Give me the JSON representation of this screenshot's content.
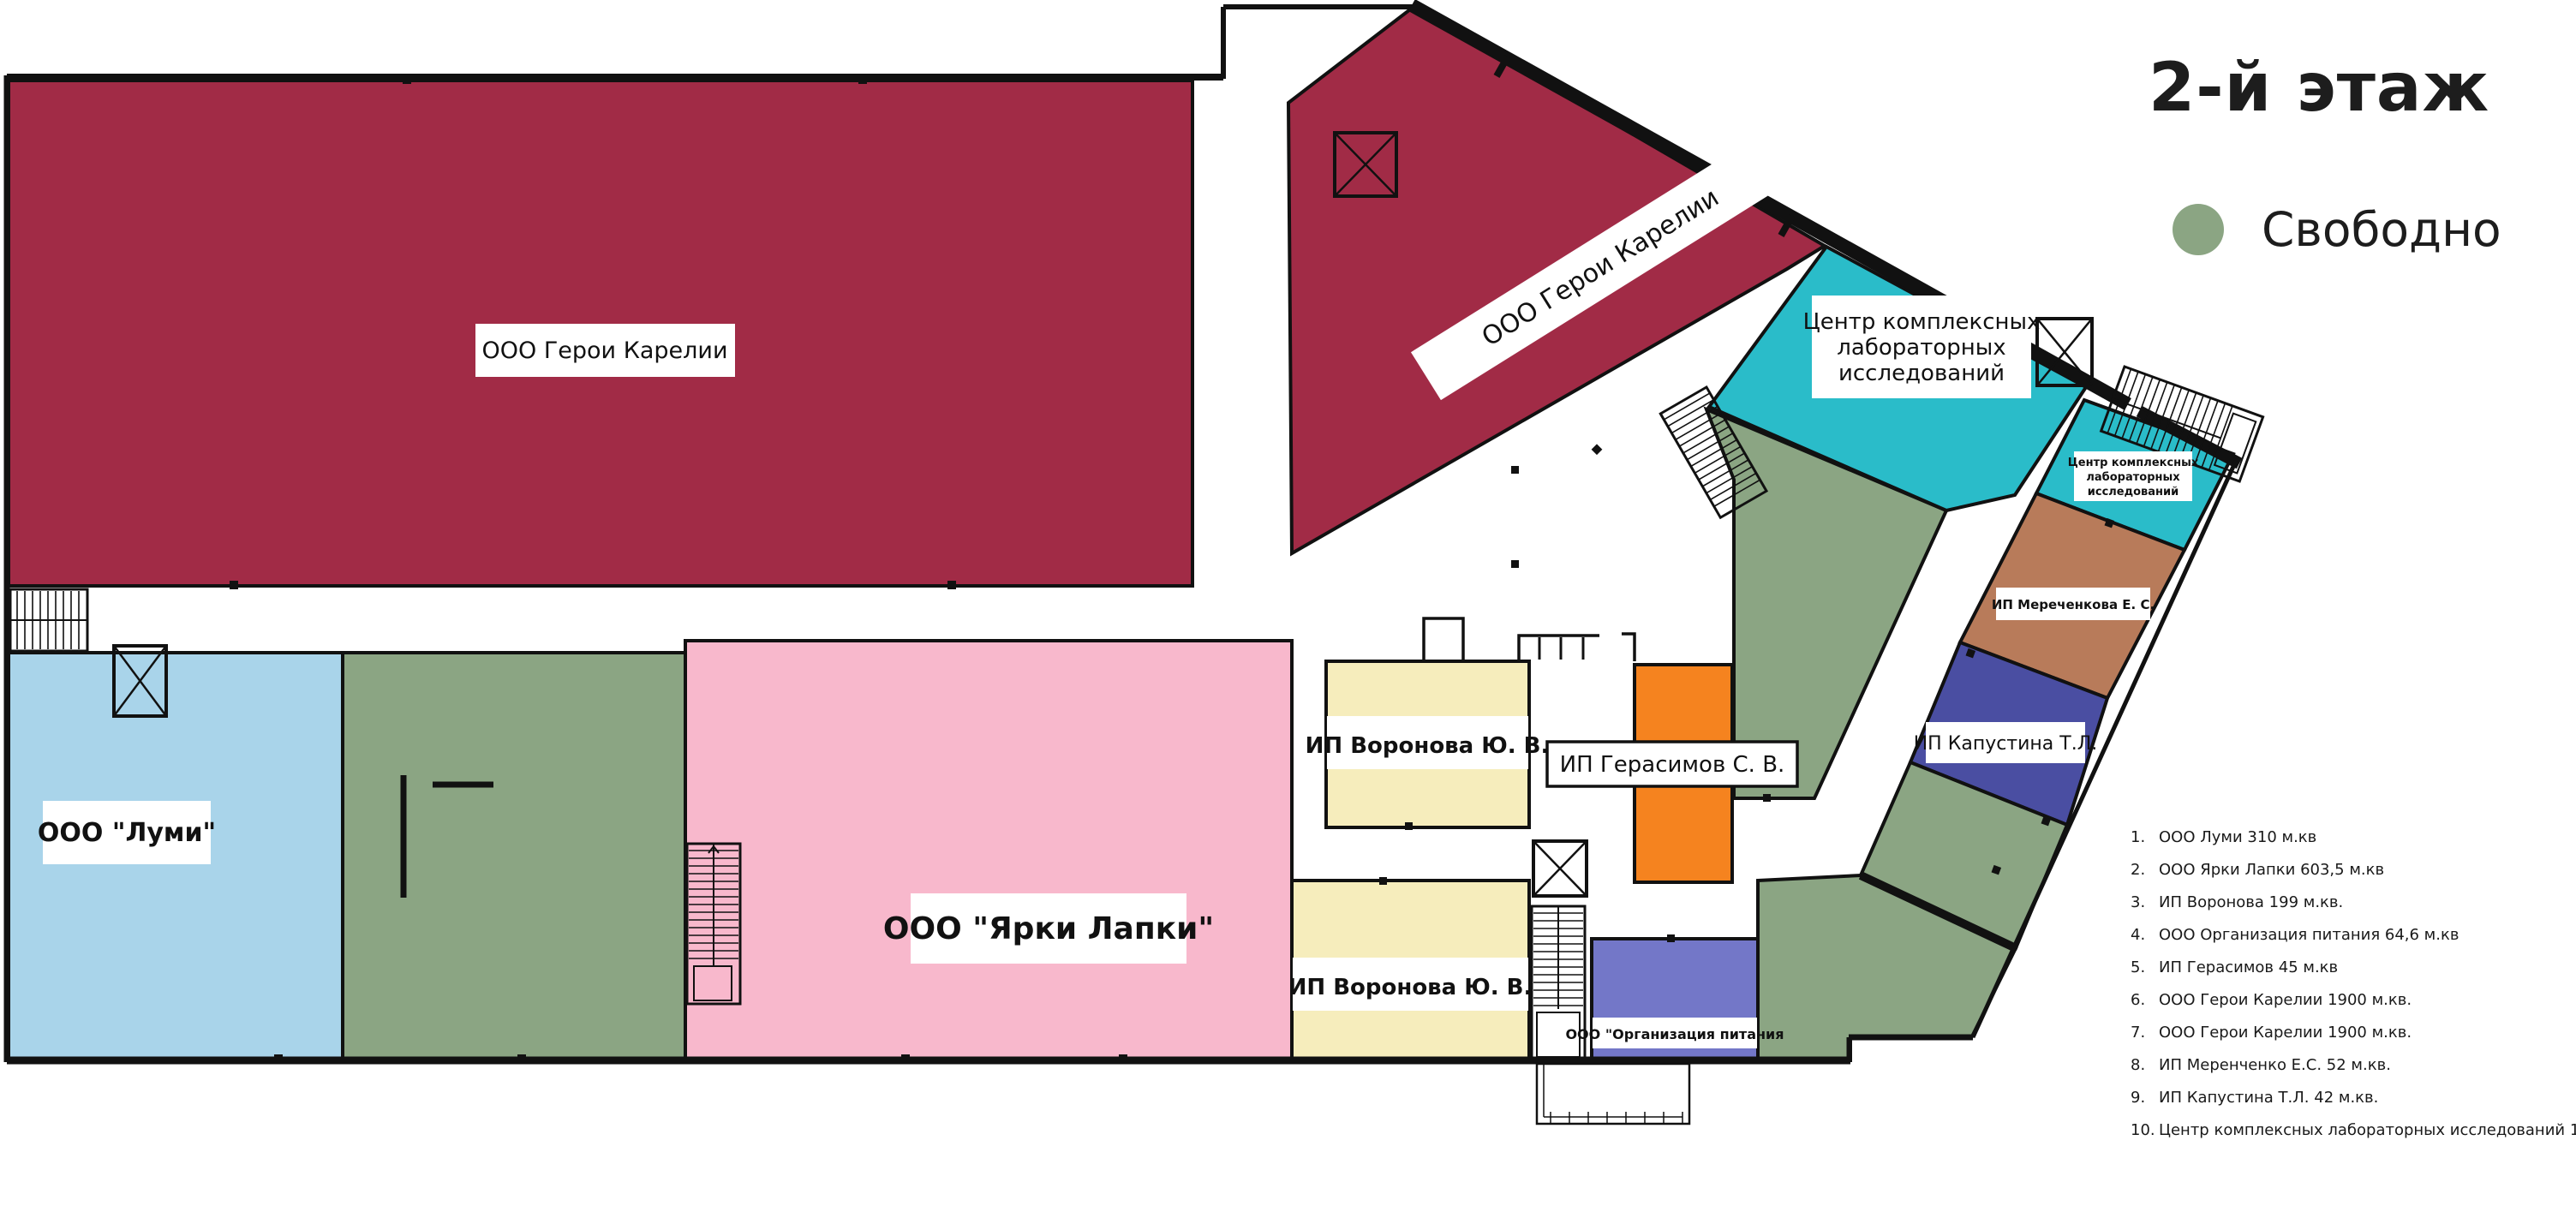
{
  "title": "2-й этаж",
  "legend": {
    "label": "Свободно",
    "color": "#8BA583"
  },
  "plan": {
    "areas": {
      "geroi1": {
        "label": "ООО Герои Карелии",
        "color": "#A12B46"
      },
      "geroi2": {
        "label": "ООО Герои Карелии",
        "color": "#A12B46"
      },
      "lumi": {
        "label": "ООО \"Луми\"",
        "color": "#A9D4EA"
      },
      "free": {
        "color": "#8BA583"
      },
      "yarki": {
        "label": "ООО \"Ярки Лапки\"",
        "color": "#F8B8CC"
      },
      "voronova_top": {
        "label": "ИП Воронова Ю. В.",
        "color": "#F6EDBC"
      },
      "voronova_bottom": {
        "label": "ИП Воронова Ю. В.",
        "color": "#F6EDBC"
      },
      "gerasimov": {
        "label": "ИП Герасимов С. В.",
        "color": "#F5831F"
      },
      "org_pitaniya": {
        "label": "ООО \"Организация питания",
        "color": "#7377C8"
      },
      "clinic_big": {
        "label_lines": [
          "Центр комплексных",
          "лабораторных",
          "исследований"
        ],
        "color": "#2ABCC9"
      },
      "clinic_small": {
        "label_lines": [
          "Центр комплексных",
          "лабораторных",
          "исследований"
        ],
        "color": "#2ABCC9"
      },
      "merechenkova": {
        "label": "ИП Мереченкова  Е. С.",
        "color": "#B87B5A"
      },
      "kapustina": {
        "label": "ИП Капустина Т.Л.",
        "color": "#4A4EA2"
      }
    }
  },
  "list": {
    "items": [
      {
        "num": "1.",
        "label": "ООО Луми 310 м.кв"
      },
      {
        "num": "2.",
        "label": "ООО Ярки Лапки  603,5 м.кв"
      },
      {
        "num": "3.",
        "label": "ИП Воронова 199 м.кв."
      },
      {
        "num": "4.",
        "label": "ООО Организация питания 64,6 м.кв"
      },
      {
        "num": "5.",
        "label": "ИП Герасимов 45 м.кв"
      },
      {
        "num": "6.",
        "label": "ООО  Герои Карелии 1900 м.кв."
      },
      {
        "num": "7.",
        "label": "ООО  Герои Карелии 1900 м.кв."
      },
      {
        "num": "8.",
        "label": "ИП Меренченко Е.С. 52 м.кв."
      },
      {
        "num": "9.",
        "label": "ИП Капустина Т.Л. 42 м.кв."
      },
      {
        "num": "10.",
        "label": "Центр комплексных лабораторных исследований 122 м.кв"
      }
    ]
  }
}
